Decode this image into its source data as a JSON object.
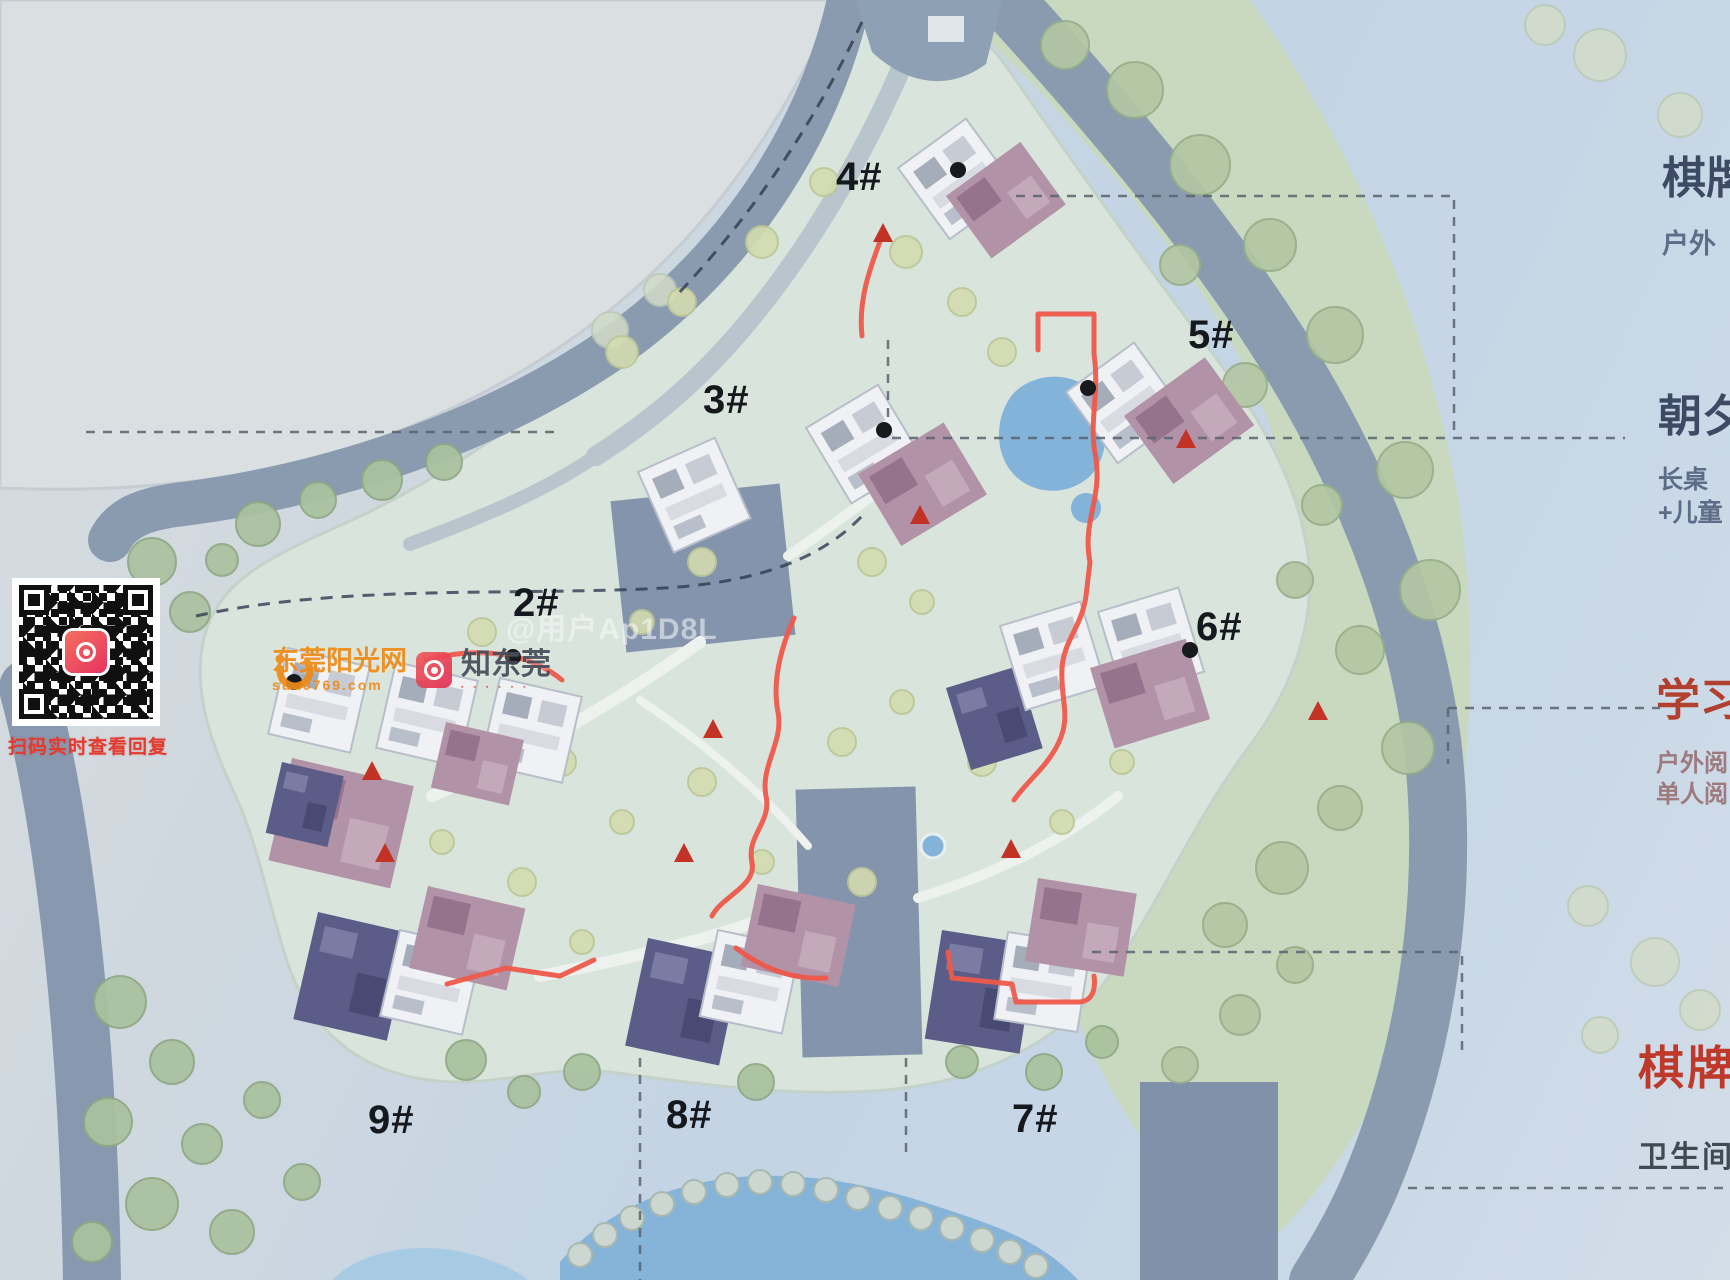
{
  "map": {
    "building_labels": [
      {
        "id": "4#"
      },
      {
        "id": "5#"
      },
      {
        "id": "3#"
      },
      {
        "id": "2#"
      },
      {
        "id": "6#"
      },
      {
        "id": "9#"
      },
      {
        "id": "8#"
      },
      {
        "id": "7#"
      }
    ]
  },
  "annotations": [
    {
      "title": "棋牌",
      "lines": [
        "户外"
      ]
    },
    {
      "title": "朝夕",
      "lines": [
        "长桌",
        "+儿童"
      ]
    },
    {
      "title": "学习",
      "lines": [
        "户外阅",
        "单人阅"
      ]
    },
    {
      "title": "棋牌",
      "lines": [
        "卫生间+"
      ]
    }
  ],
  "qr": {
    "caption": "扫码实时查看回复"
  },
  "watermarks": {
    "site_name": "东莞阳光网",
    "site_domain": "sun0769.com",
    "site_badge": "知东莞",
    "badge_dots": "▪ ▪ ▪ ▪ ▪ ▪",
    "user": "@用户Ap1D8L"
  },
  "colors": {
    "accent_path_red": "#ee584a",
    "annotation_navy": "#3d4a63",
    "annotation_red": "#b5402e",
    "building_label_black": "#15181d",
    "qr_caption_red": "#e23a2e",
    "watermark_orange": "#ef8a16",
    "road_gray_blue": "#8a9bb0",
    "green_area": "#c9d9c0",
    "pond_blue": "#83b3d9"
  }
}
